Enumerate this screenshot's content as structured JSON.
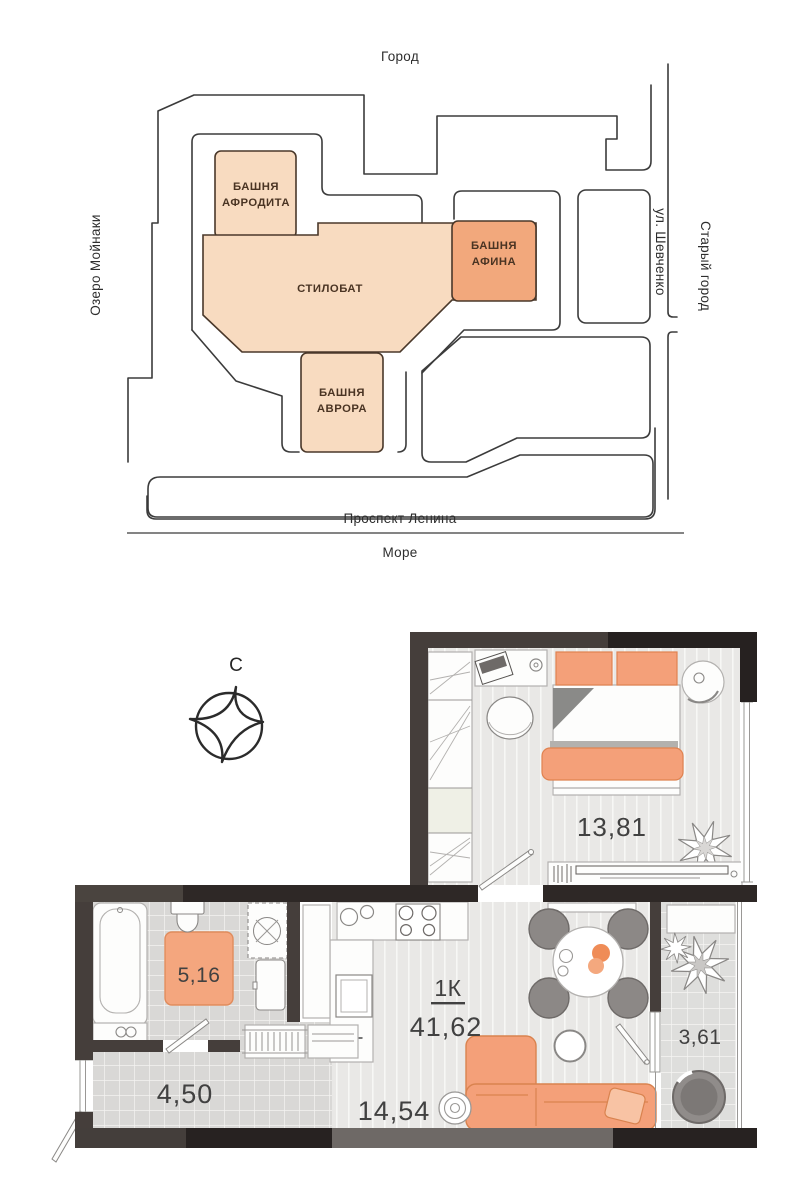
{
  "site_plan": {
    "surroundings": {
      "top": "Город",
      "left": "Озеро Мойнаки",
      "street_right": "ул. Шевченко",
      "right": "Старый город",
      "street_bottom": "Проспект Ленина",
      "bottom": "Море"
    },
    "buildings": {
      "aphrodite": {
        "line1": "БАШНЯ",
        "line2": "АФРОДИТА"
      },
      "stylobate": {
        "label": "СТИЛОБАТ"
      },
      "athena": {
        "line1": "БАШНЯ",
        "line2": "АФИНА"
      },
      "aurora": {
        "line1": "БАШНЯ",
        "line2": "АВРОРА"
      }
    },
    "colors": {
      "building_light": "#f8dbc0",
      "building_dark": "#f2a87c",
      "road_line": "#3b3b3b"
    }
  },
  "floor_plan": {
    "compass_label": "С",
    "unit_type": "1К",
    "total_area": "41,62",
    "rooms": {
      "bedroom": "13,81",
      "bathroom": "5,16",
      "hallway": "4,50",
      "kitchen_living": "14,54",
      "balcony": "3,61"
    },
    "colors": {
      "wall_dark": "#453e3b",
      "wall_black": "#272221",
      "accent_orange": "#f4a079"
    }
  }
}
